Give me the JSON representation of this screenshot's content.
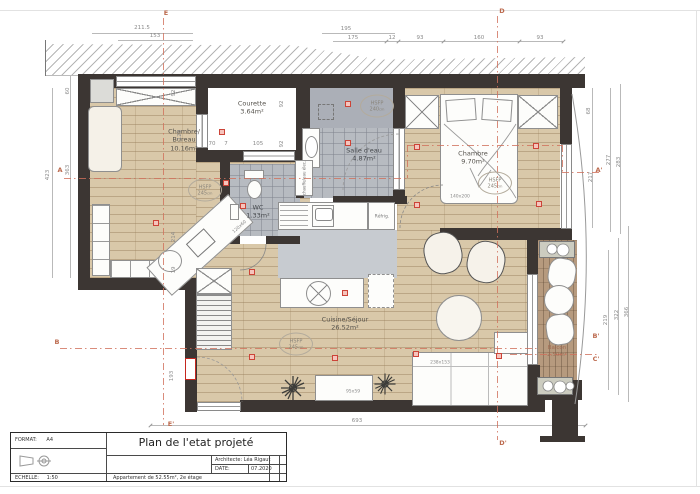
{
  "title_block": {
    "format_label": "FORMAT:",
    "format_value": "A4",
    "title": "Plan de l'etat projeté",
    "architect_label": "Architecte:",
    "architect_value": "Léa Rigaut",
    "date_label": "DATE:",
    "date_value": "07.2020",
    "scale_label": "ECHELLE:",
    "scale_value": "1:50",
    "subtitle": "Appartement de 52.55m², 2e étage"
  },
  "rooms": {
    "chambre_bureau": {
      "name_line1": "Chambre/",
      "name_line2": "Bureau",
      "area": "10.16m²"
    },
    "courette": {
      "name": "Courette",
      "area": "3.64m²"
    },
    "salle_eau": {
      "name": "Salle d'eau",
      "area": "4.87m²"
    },
    "wc": {
      "name": "WC",
      "area": "1.33m²"
    },
    "chambre": {
      "name": "Chambre",
      "area": "9.70m²"
    },
    "cuisine_sejour": {
      "name": "Cuisine/Séjour",
      "area": "26.52m²"
    },
    "balcon": {
      "name": "Balcon",
      "area": "2.50m²"
    }
  },
  "height_labels": [
    {
      "label": "HSFP",
      "value": "245",
      "unit": "cm",
      "x": 205,
      "y": 190
    },
    {
      "label": "HSFP",
      "value": "240",
      "unit": "cm",
      "x": 377,
      "y": 106
    },
    {
      "label": "HSFP",
      "value": "245",
      "unit": "cm",
      "x": 495,
      "y": 183
    },
    {
      "label": "HSFP",
      "value": "245",
      "unit": "cm",
      "x": 296,
      "y": 344
    }
  ],
  "furniture_labels": {
    "bed": "140x200",
    "desk": "120x60",
    "sofa": "238x153",
    "coffee_table": "95x59"
  },
  "appliance_labels": {
    "fridge": "Réfrig.",
    "water_heater": "chauffe/eau élec."
  },
  "dimensions": [
    {
      "text": "211.5",
      "x": 142,
      "y": 28
    },
    {
      "text": "153",
      "x": 155,
      "y": 36
    },
    {
      "text": "195",
      "x": 346,
      "y": 29
    },
    {
      "text": "175",
      "x": 353,
      "y": 38
    },
    {
      "text": "12",
      "x": 392,
      "y": 38
    },
    {
      "text": "93",
      "x": 420,
      "y": 38
    },
    {
      "text": "160",
      "x": 479,
      "y": 38
    },
    {
      "text": "93",
      "x": 540,
      "y": 38
    },
    {
      "text": "423",
      "x": 48,
      "y": 175,
      "rot": -90
    },
    {
      "text": "60",
      "x": 68,
      "y": 91,
      "rot": -90
    },
    {
      "text": "363",
      "x": 68,
      "y": 170,
      "rot": -90
    },
    {
      "text": "68",
      "x": 589,
      "y": 111,
      "rot": -90
    },
    {
      "text": "217",
      "x": 591,
      "y": 177,
      "rot": -90
    },
    {
      "text": "277",
      "x": 609,
      "y": 160,
      "rot": -90
    },
    {
      "text": "283",
      "x": 619,
      "y": 162,
      "rot": -90
    },
    {
      "text": "219",
      "x": 606,
      "y": 320,
      "rot": -90
    },
    {
      "text": "322",
      "x": 617,
      "y": 315,
      "rot": -90
    },
    {
      "text": "366",
      "x": 627,
      "y": 312,
      "rot": -90
    },
    {
      "text": "693",
      "x": 357,
      "y": 421
    },
    {
      "text": "193",
      "x": 172,
      "y": 376,
      "rot": -90
    },
    {
      "text": "70",
      "x": 212,
      "y": 144
    },
    {
      "text": "7",
      "x": 226,
      "y": 144
    },
    {
      "text": "105",
      "x": 258,
      "y": 144
    },
    {
      "text": "92",
      "x": 282,
      "y": 104,
      "rot": -90
    },
    {
      "text": "92",
      "x": 282,
      "y": 144,
      "rot": -90
    },
    {
      "text": "92",
      "x": 174,
      "y": 93,
      "rot": -90
    },
    {
      "text": "120",
      "x": 180,
      "y": 135,
      "rot": -90
    },
    {
      "text": "214",
      "x": 174,
      "y": 237,
      "rot": -90
    },
    {
      "text": "19",
      "x": 174,
      "y": 270,
      "rot": -90
    }
  ],
  "outlets": [
    [
      222,
      132
    ],
    [
      226,
      183
    ],
    [
      156,
      223
    ],
    [
      243,
      206
    ],
    [
      348,
      104
    ],
    [
      348,
      143
    ],
    [
      417,
      147
    ],
    [
      417,
      205
    ],
    [
      536,
      146
    ],
    [
      539,
      204
    ],
    [
      252,
      272
    ],
    [
      252,
      357
    ],
    [
      335,
      358
    ],
    [
      416,
      354
    ],
    [
      499,
      356
    ],
    [
      345,
      293
    ]
  ],
  "section_markers": [
    {
      "text": "E",
      "x": 166,
      "y": 13
    },
    {
      "text": "D",
      "x": 502,
      "y": 11
    },
    {
      "text": "A",
      "x": 60,
      "y": 170
    },
    {
      "text": "B",
      "x": 57,
      "y": 342
    },
    {
      "text": "A'",
      "x": 599,
      "y": 170
    },
    {
      "text": "B'",
      "x": 596,
      "y": 336
    },
    {
      "text": "C'",
      "x": 596,
      "y": 359
    },
    {
      "text": "E'",
      "x": 171,
      "y": 424
    },
    {
      "text": "D'",
      "x": 503,
      "y": 443
    }
  ]
}
